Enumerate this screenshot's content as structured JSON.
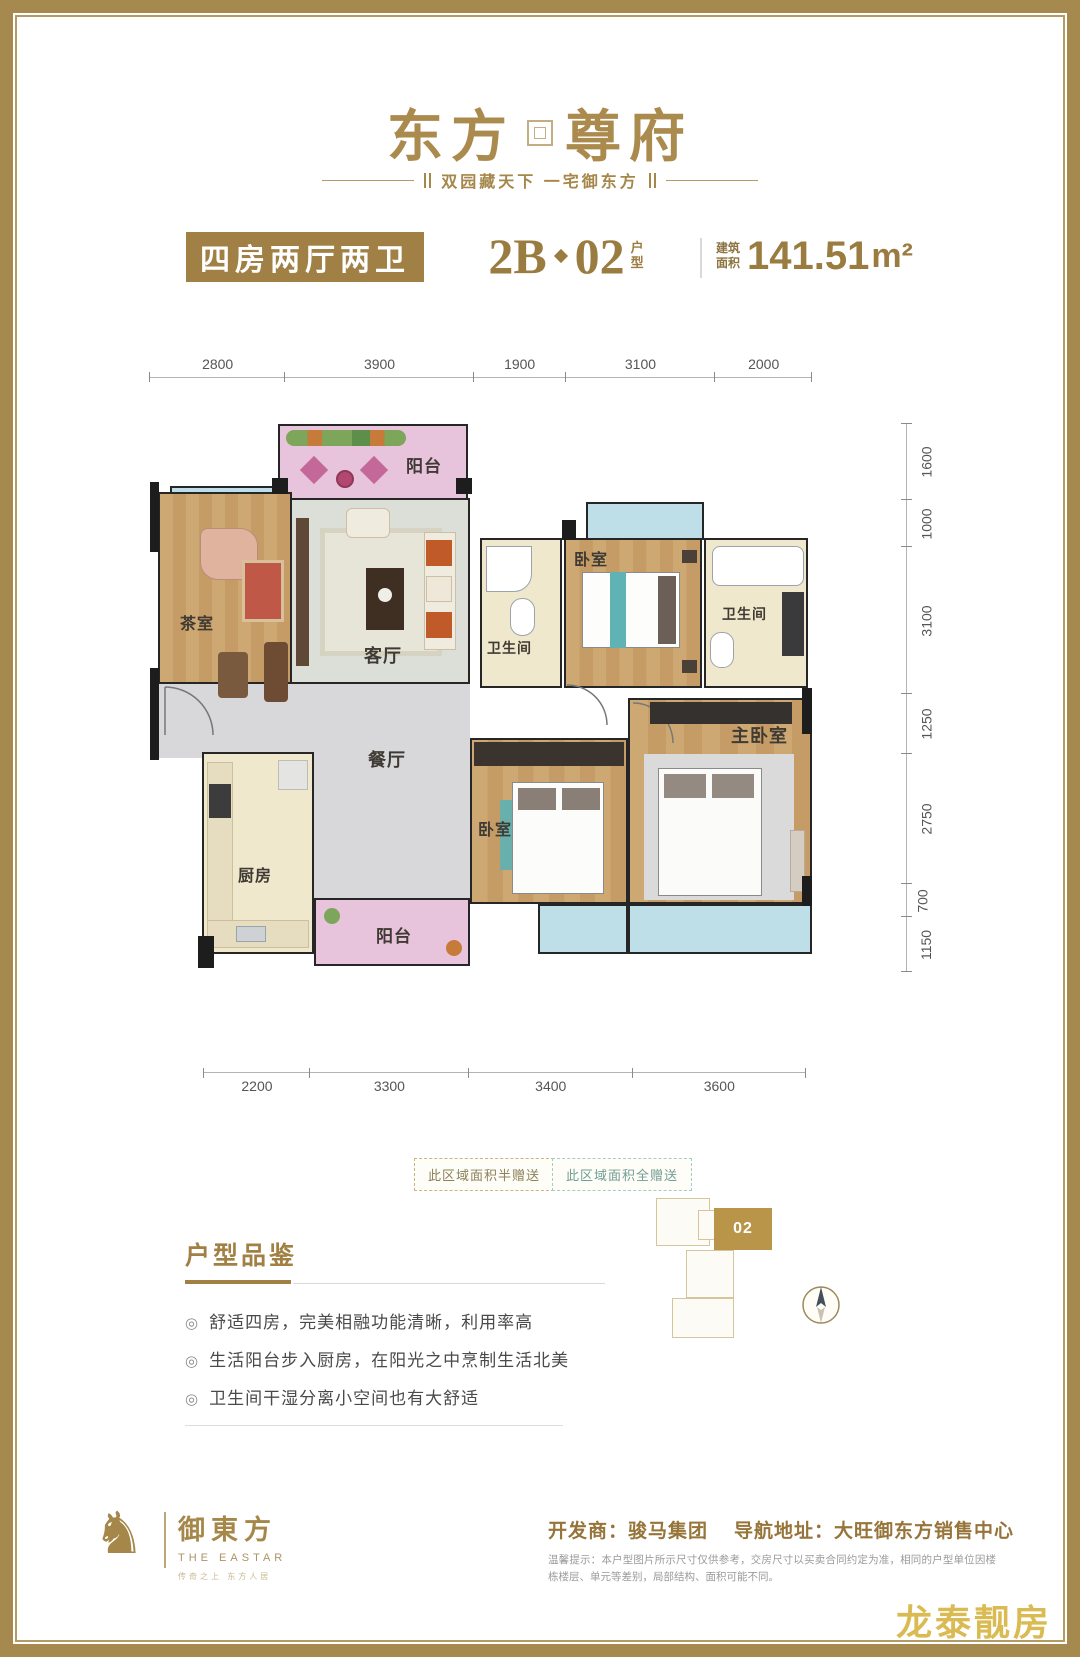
{
  "brand": {
    "logo_left": "东方",
    "logo_right": "尊府",
    "tagline": "双园藏天下 一宅御东方"
  },
  "header": {
    "type_badge": "四房两厅两卫",
    "unit_prefix": "2B",
    "unit_number": "02",
    "unit_suffix_top": "户",
    "unit_suffix_bottom": "型",
    "area_label_top": "建筑",
    "area_label_bottom": "面积",
    "area_value": "141.51",
    "area_unit": "m²"
  },
  "plan": {
    "dims_top": [
      "2800",
      "3900",
      "1900",
      "3100",
      "2000"
    ],
    "dims_right": [
      "1600",
      "1000",
      "3100",
      "1250",
      "2750",
      "700",
      "1150"
    ],
    "dims_bottom": [
      "2200",
      "3300",
      "3400",
      "3600"
    ],
    "rooms": {
      "balcony_top": "阳台",
      "tea_room": "茶室",
      "living": "客厅",
      "bath_left": "卫生间",
      "bedroom_top": "卧室",
      "bath_right": "卫生间",
      "dining": "餐厅",
      "kitchen": "厨房",
      "balcony_bottom": "阳台",
      "bedroom_mid": "卧室",
      "master": "主卧室"
    },
    "legend_half": "此区域面积半赠送",
    "legend_full": "此区域面积全赠送"
  },
  "features": {
    "title": "户型品鉴",
    "items": [
      "舒适四房，完美相融功能清晰，利用率高",
      "生活阳台步入厨房，在阳光之中烹制生活北美",
      "卫生间干湿分离小空间也有大舒适"
    ]
  },
  "siteplan": {
    "unit_label": "02"
  },
  "footer": {
    "logo_cn": "御東方",
    "logo_en": "THE EASTAR",
    "logo_sub": "传奇之上 东方人居",
    "developer": "开发商：骏马集团",
    "address": "导航地址：大旺御东方销售中心",
    "disclaimer": "温馨提示：本户型图片所示尺寸仅供参考，交房尺寸以买卖合同约定为准，相同的户型单位因楼栋楼层、单元等差别，局部结构、面积可能不同。"
  },
  "watermark": "龙泰靓房",
  "colors": {
    "brand_gold": "#a5874a",
    "badge_gold": "#a08044",
    "wall": "#262626",
    "balcony_pink": "#e7c3dc",
    "balcony_blue": "#bedee8",
    "wood_floor": "#c9a26e",
    "tile_cream": "#f0e8cd",
    "floor_gray": "#d8d8da",
    "watermark_gold": "#d9b84a"
  }
}
